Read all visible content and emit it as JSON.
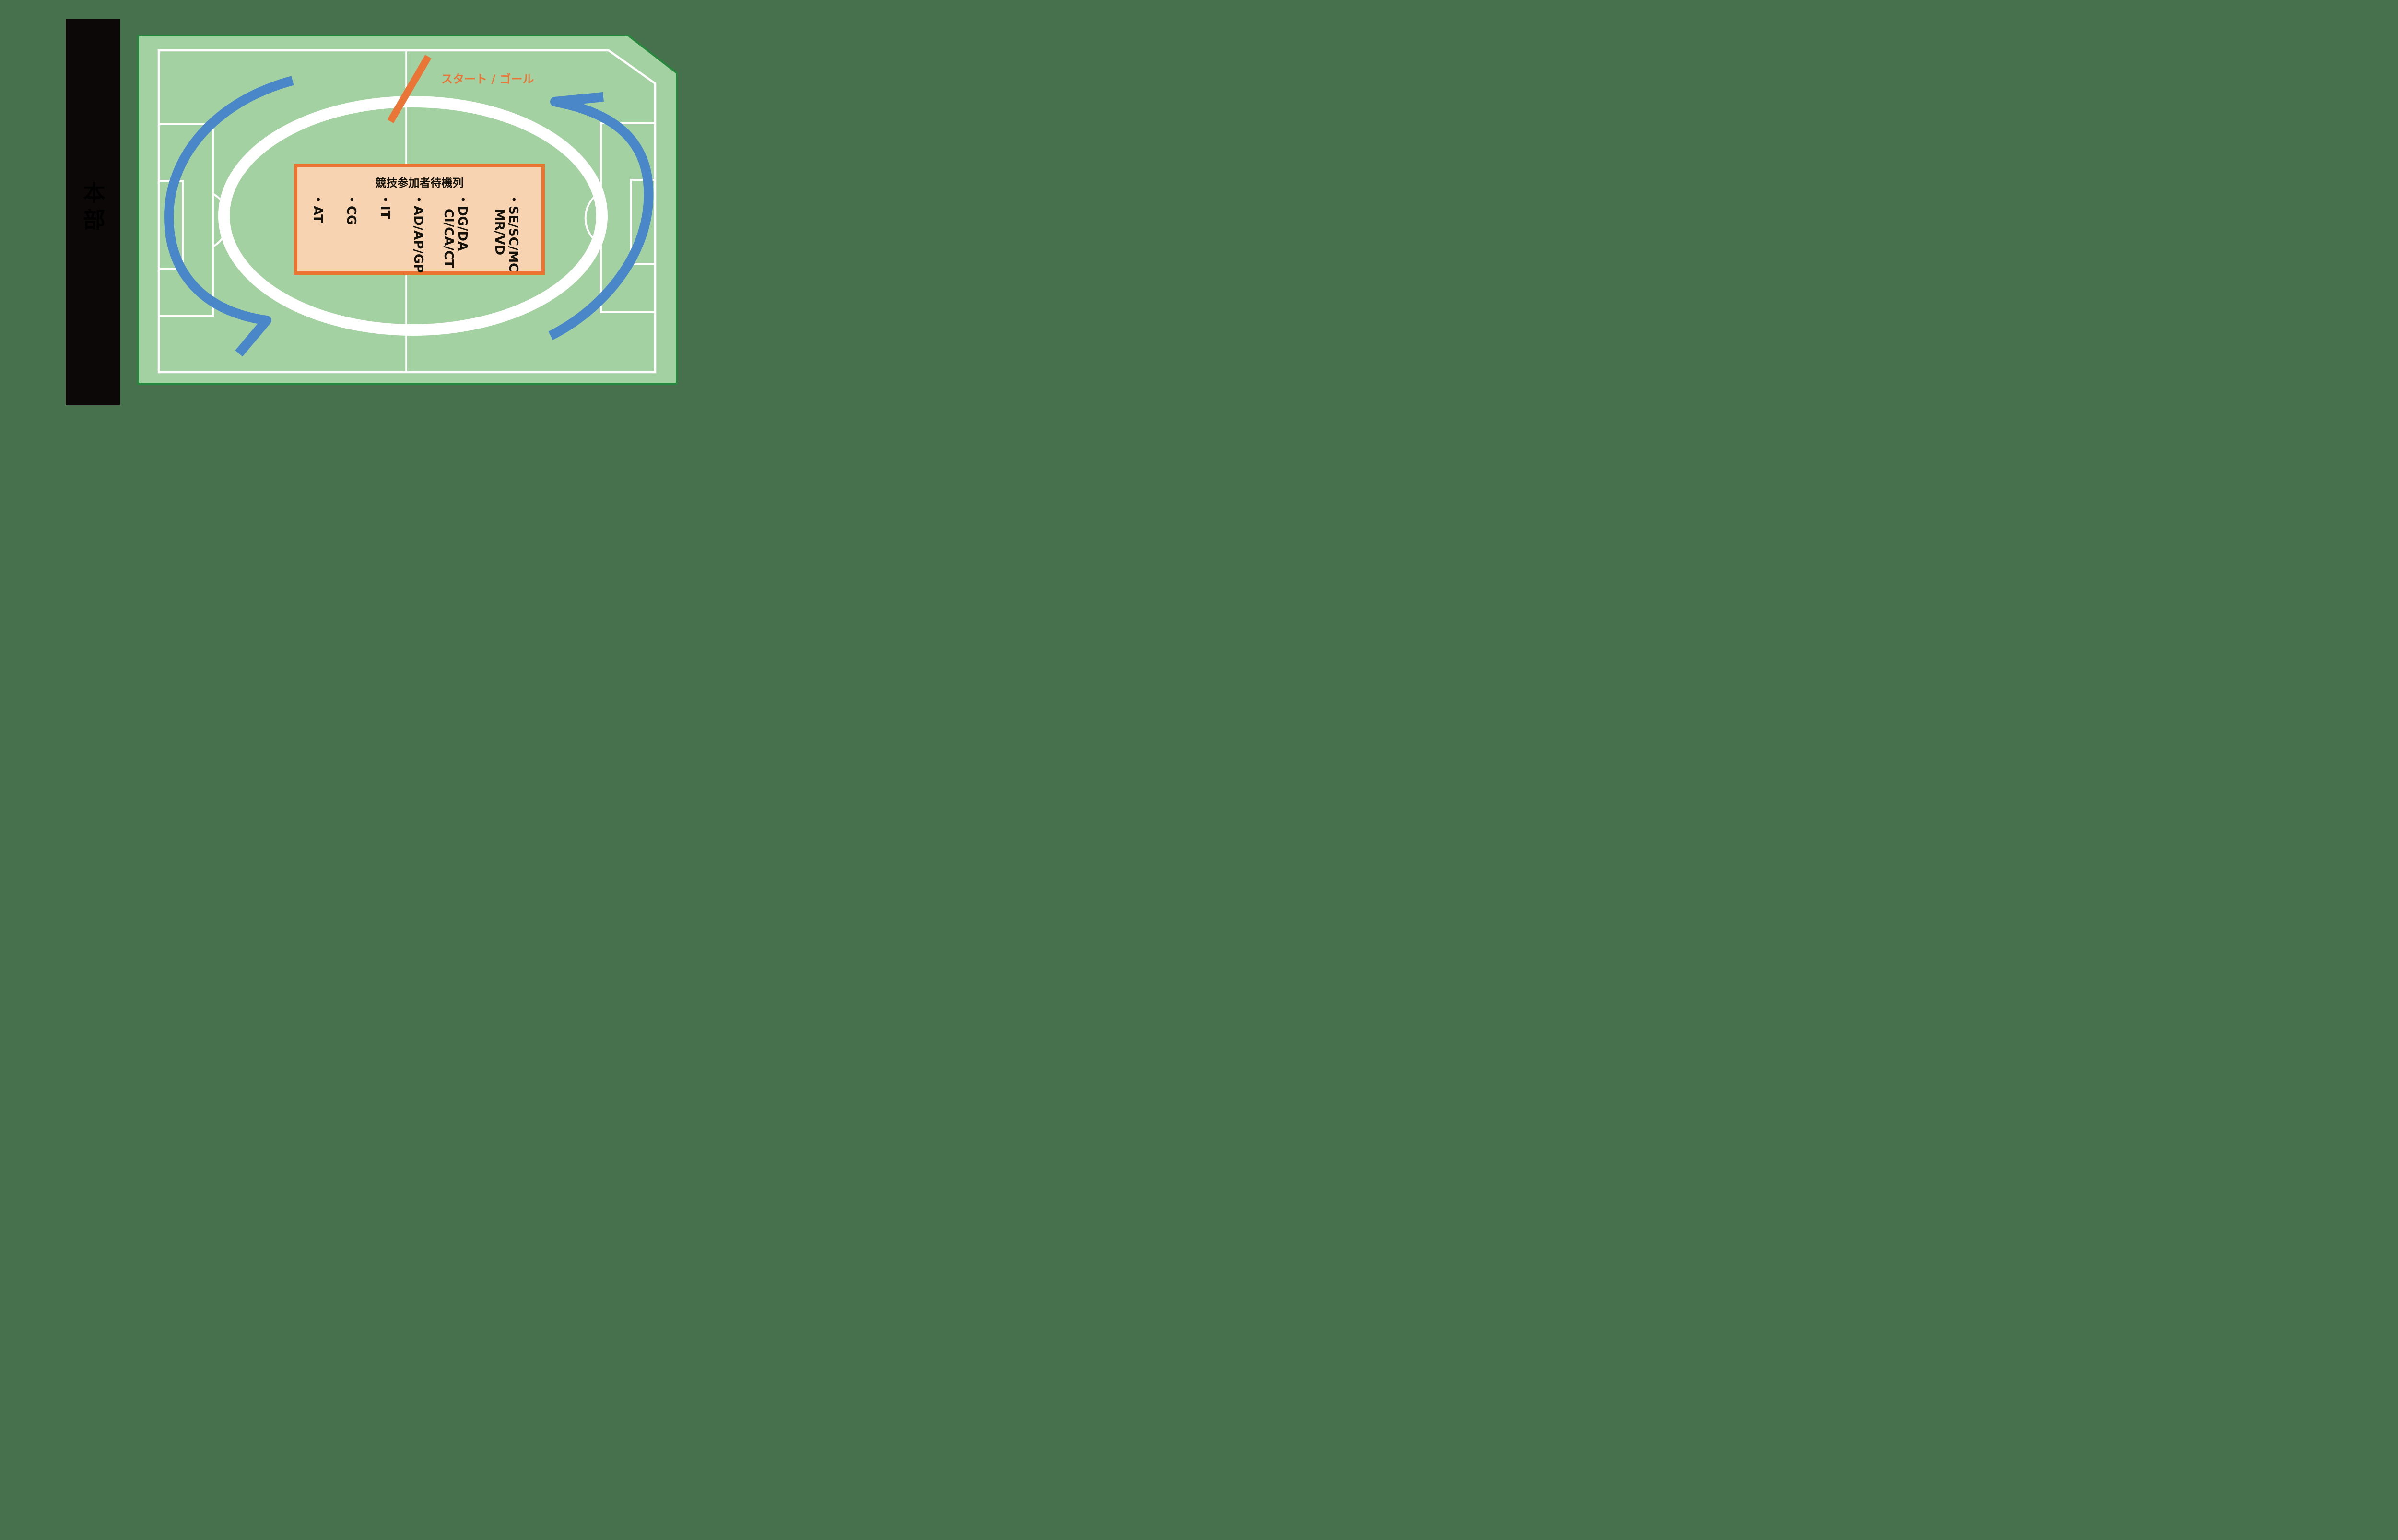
{
  "page": {
    "background": "#47714d"
  },
  "hq": {
    "label": "本部"
  },
  "field": {
    "turf_color": "#a3d1a2",
    "border_color": "#27873c",
    "line_color": "#ffffff"
  },
  "track": {
    "color": "#ffffff"
  },
  "flow_arrows": {
    "color": "#4a87c9",
    "direction": "counterclockwise"
  },
  "start_goal": {
    "label": "スタート / ゴール",
    "color": "#e97636"
  },
  "waiting_box": {
    "title": "競技参加者待機列",
    "fill": "#f8d3b1",
    "border": "#ed7331",
    "items": [
      {
        "l1": "・AT",
        "l2": ""
      },
      {
        "l1": "・CG",
        "l2": ""
      },
      {
        "l1": "・IT",
        "l2": ""
      },
      {
        "l1": "・AD/AP/GP",
        "l2": ""
      },
      {
        "l1": "・DG/DA",
        "l2": "CI/CA/CT"
      },
      {
        "l1": "・SE/SC/MC",
        "l2": "MR/VD"
      }
    ]
  }
}
